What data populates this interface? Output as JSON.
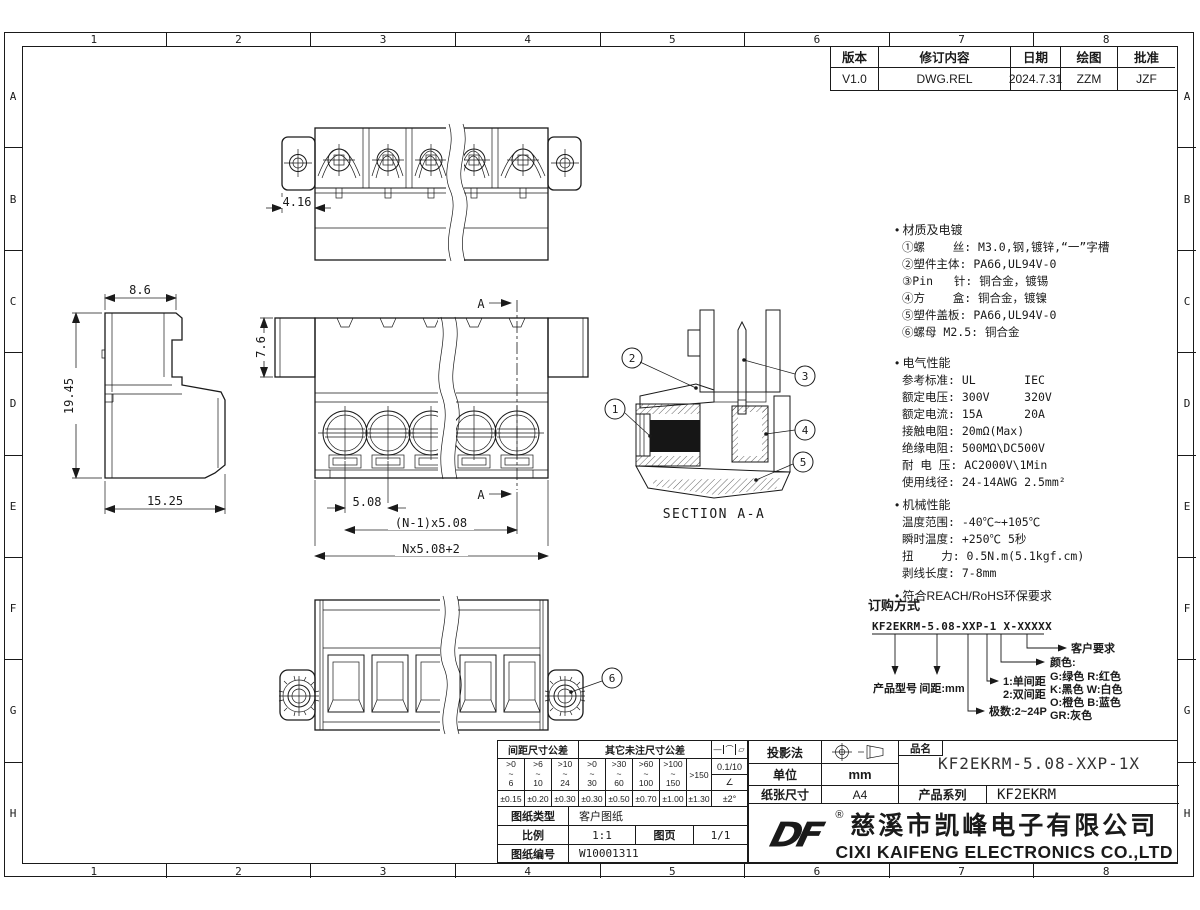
{
  "frame": {
    "cols": [
      "1",
      "2",
      "3",
      "4",
      "5",
      "6",
      "7",
      "8"
    ],
    "rows": [
      "A",
      "B",
      "C",
      "D",
      "E",
      "F",
      "G",
      "H"
    ]
  },
  "revision": {
    "headers": [
      "版本",
      "修订内容",
      "日期",
      "绘图",
      "批准"
    ],
    "row": {
      "version": "V1.0",
      "content": "DWG.REL",
      "date": "2024.7.31",
      "draw": "ZZM",
      "approve": "JZF"
    }
  },
  "dims": {
    "top_flange": "4.16",
    "side_top": "8.6",
    "side_height": "19.45",
    "side_bottom": "15.25",
    "front_depth": "7.6",
    "pitch": "5.08",
    "pitch_span": "(N-1)x5.08",
    "total": "Nx5.08+2",
    "section_mark": "A",
    "section_title": "SECTION A-A",
    "callouts": [
      "1",
      "2",
      "3",
      "4",
      "5",
      "6"
    ]
  },
  "notes": {
    "material_title": "材质及电镀",
    "material": [
      "①螺    丝: M3.0,钢,镀锌,“一”字槽",
      "②塑件主体: PA66,UL94V-0",
      "③Pin   针: 铜合金，镀锡",
      "④方    盒: 铜合金，镀镍",
      "⑤塑件盖板: PA66,UL94V-0",
      "⑥螺母 M2.5: 铜合金"
    ],
    "electrical_title": "电气性能",
    "electrical": [
      "参考标准: UL       IEC",
      "额定电压: 300V     320V",
      "额定电流: 15A      20A",
      "接触电阻: 20mΩ(Max)",
      "绝缘电阻: 500MΩ\\DC500V",
      "耐 电 压: AC2000V\\1Min",
      "使用线径: 24-14AWG 2.5mm²"
    ],
    "mechanical_title": "机械性能",
    "mechanical": [
      "温度范围: -40℃~+105℃",
      "瞬时温度: +250℃ 5秒",
      "扭    力: 0.5N.m(5.1kgf.cm)",
      "剥线长度: 7-8mm"
    ],
    "compliance": "符合REACH/RoHS环保要求"
  },
  "ordering": {
    "title": "订购方式",
    "code": "KF2EKRM-5.08-XXP-1 X-XXXXX",
    "model_label": "产品型号",
    "pitch_label": "间距:mm",
    "poles_label": "极数:2~24P",
    "single_label": "1:单间距",
    "double_label": "2:双间距",
    "color_label": "颜色:",
    "colors": [
      "G:绿色  R:红色",
      "K:黑色  W:白色",
      "O:橙色  B:蓝色",
      "GR:灰色"
    ],
    "customer_label": "客户要求"
  },
  "titleblock": {
    "tol_pitch_header": "间距尺寸公差",
    "tol_other_header": "其它未注尺寸公差",
    "ranges": [
      ">0\n~\n6",
      ">6\n~\n10",
      ">10\n~\n24",
      ">0\n~\n30",
      ">30\n~\n60",
      ">60\n~\n100",
      ">100\n~\n150",
      ">150"
    ],
    "tols": [
      "±0.15",
      "±0.20",
      "±0.30",
      "±0.30",
      "±0.50",
      "±0.70",
      "±1.00",
      "±1.30"
    ],
    "sym1": "—",
    "sym2": "⌒",
    "sym3": "▱",
    "flat_val": "0.1/10",
    "angle_sym": "∠",
    "angle_val": "±2°",
    "doc_type_label": "图纸类型",
    "doc_type": "客户图纸",
    "scale_label": "比例",
    "scale": "1:1",
    "sheet_label": "图页",
    "sheet": "1/1",
    "docno_label": "图纸编号",
    "docno": "W10001311",
    "projection_label": "投影法",
    "unit_label": "单位",
    "unit": "mm",
    "paper_label": "纸张尺寸",
    "paper": "A4",
    "name_label": "品名",
    "name": "KF2EKRM-5.08-XXP-1X",
    "series_label": "产品系列",
    "series": "KF2EKRM",
    "logo": "DF",
    "reg": "®",
    "company_cn": "慈溪市凯峰电子有限公司",
    "company_en": "CIXI KAIFENG ELECTRONICS CO.,LTD"
  }
}
